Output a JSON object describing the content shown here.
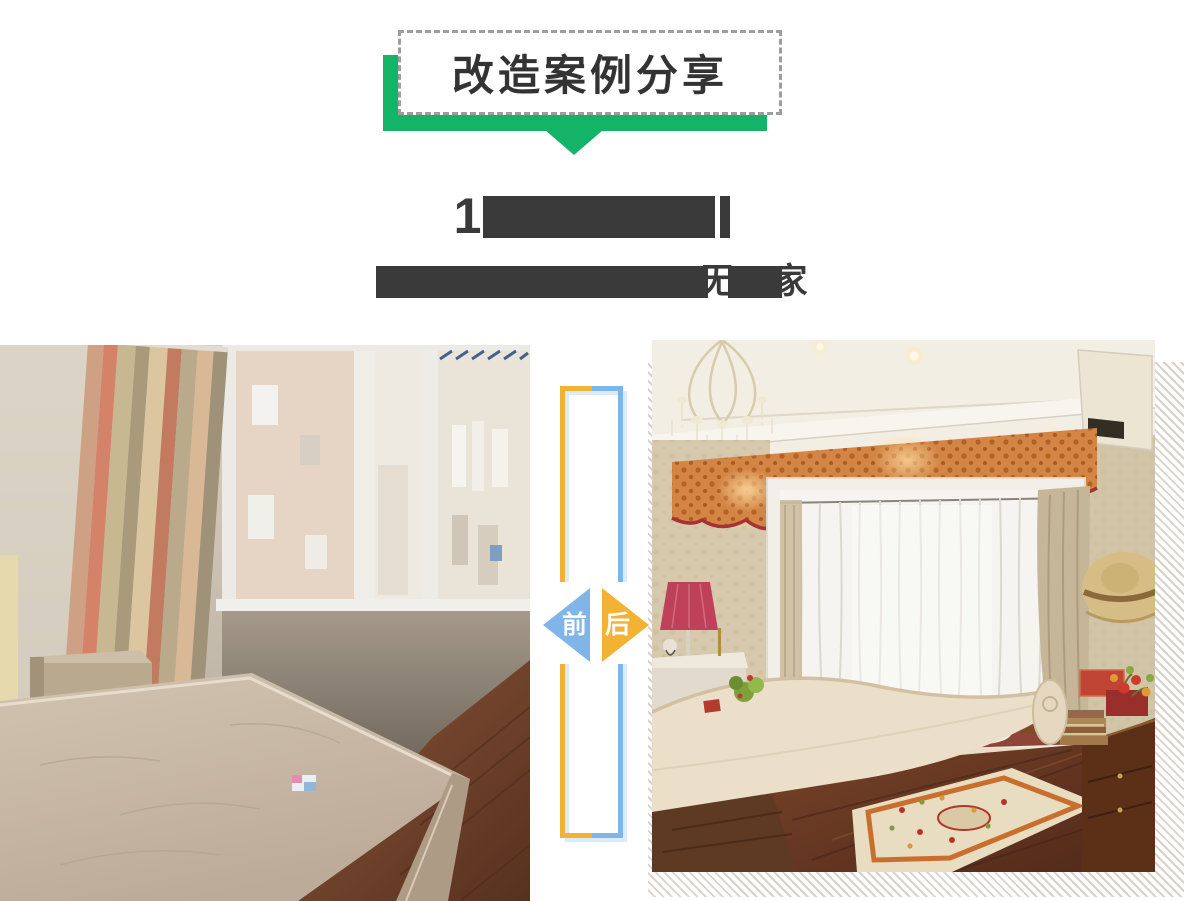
{
  "header": {
    "title": "改造案例分享",
    "accent_green": "#13b468",
    "dashed_border_color": "#9d9d9d"
  },
  "redacted": {
    "note": "article title and subtitle are blacked out in the image",
    "line1_visible_fragment": "1",
    "line2_visible_fragment_mid": "无",
    "line2_visible_fragment_end": "家",
    "bar_color": "#3a3a3a"
  },
  "divider": {
    "before_label": "前",
    "after_label": "后",
    "yellow": "#f2b233",
    "blue": "#7fb5e8",
    "shadow_blue": "#dcebf9"
  },
  "photos": {
    "before": {
      "label": "改造前",
      "description": "旧卧室：裸床垫、旧窗帘、窗外楼房"
    },
    "after": {
      "label": "改造后",
      "description": "欧式卧室：水晶吊灯、飘窗、幔帘、地毯"
    }
  }
}
